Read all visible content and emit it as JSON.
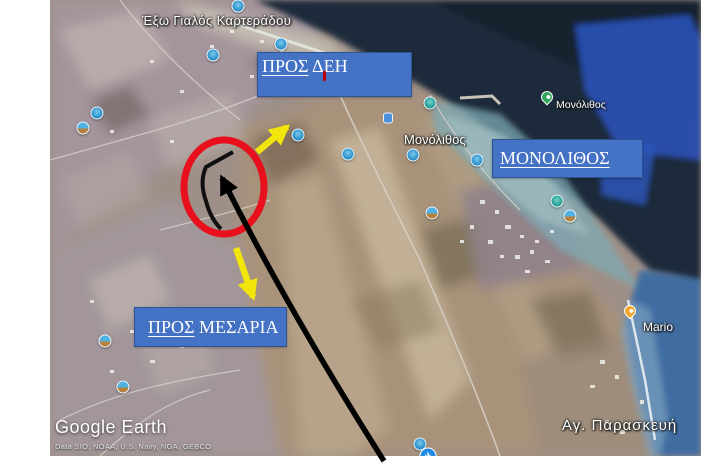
{
  "map": {
    "logo": "Google Earth",
    "attribution": "Data SIO, NOAA, U.S. Navy, NGA, GEBCO",
    "labels": {
      "exo_gialos": "Έξω Γιαλός Καρτεράδου",
      "monolithos_map": "Μονόλιθος",
      "monolithos_poi": "Μονόλιθος",
      "ag_paraskevi": "Αγ. Παρασκευή",
      "mario": "Mario"
    },
    "markers": [
      {
        "type": "photo",
        "x": 238,
        "y": 6
      },
      {
        "type": "photo",
        "x": 281,
        "y": 44
      },
      {
        "type": "photo",
        "x": 213,
        "y": 55
      },
      {
        "type": "photo",
        "x": 97,
        "y": 113
      },
      {
        "type": "photo-orange",
        "x": 83,
        "y": 128
      },
      {
        "type": "photo",
        "x": 298,
        "y": 135
      },
      {
        "type": "photo",
        "x": 348,
        "y": 154
      },
      {
        "type": "teal",
        "x": 430,
        "y": 103
      },
      {
        "type": "square",
        "x": 388,
        "y": 118
      },
      {
        "type": "photo",
        "x": 413,
        "y": 155
      },
      {
        "type": "photo",
        "x": 477,
        "y": 160
      },
      {
        "type": "photo-orange",
        "x": 432,
        "y": 213
      },
      {
        "type": "teal",
        "x": 557,
        "y": 201
      },
      {
        "type": "photo-orange",
        "x": 570,
        "y": 216
      },
      {
        "type": "photo-orange",
        "x": 105,
        "y": 341
      },
      {
        "type": "photo-orange",
        "x": 123,
        "y": 387
      },
      {
        "type": "photo",
        "x": 420,
        "y": 444
      },
      {
        "type": "airport",
        "x": 428,
        "y": 456
      },
      {
        "type": "pin-green",
        "x": 547,
        "y": 103
      },
      {
        "type": "pin-orange",
        "x": 630,
        "y": 317
      }
    ]
  },
  "annotations": {
    "box_dei": {
      "underlined": "ΠΡΟΣ",
      "rest": " ΔΕΗ"
    },
    "box_monolithos": {
      "underlined": "ΜΟΝΟΛΙΘΟΣ",
      "rest": ""
    },
    "box_mesaria": {
      "underlined": "ΠΡΟΣ",
      "rest": " ΜΕΣΑΡΙΑ"
    },
    "colors": {
      "box_fill": "#4472c4",
      "box_border": "#2f5496",
      "ellipse_red": "#e8101c",
      "arrow_yellow": "#f2e50b",
      "arrow_black": "#000000",
      "red_tick": "#c00000"
    }
  }
}
